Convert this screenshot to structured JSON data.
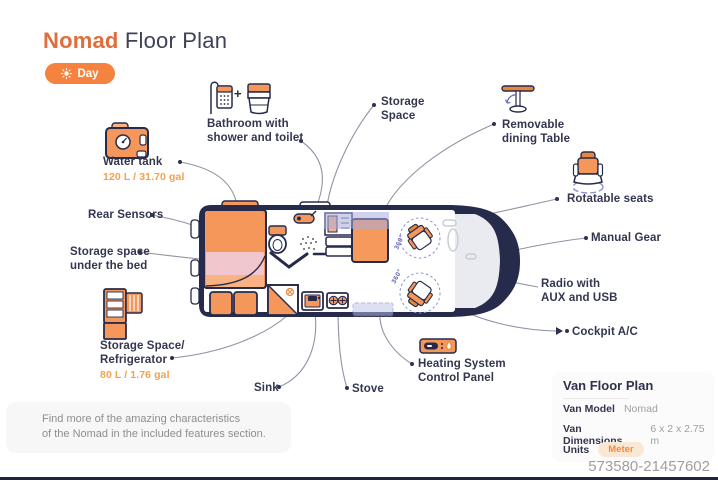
{
  "header": {
    "title_accent": "Nomad",
    "title_rest": " Floor Plan",
    "day_toggle": "Day"
  },
  "callouts": {
    "bathroom": {
      "lines": [
        "Bathroom with",
        "shower and toilet"
      ]
    },
    "storage_space": {
      "lines": [
        "Storage",
        "Space"
      ]
    },
    "dining_table": {
      "lines": [
        "Removable",
        "dining Table"
      ]
    },
    "water_tank": {
      "lines": [
        "Water tank"
      ],
      "value": "120 L / 31.70 gal"
    },
    "rear_sensors": {
      "lines": [
        "Rear Sensors"
      ]
    },
    "under_bed": {
      "lines": [
        "Storage space",
        "under the bed"
      ]
    },
    "rotatable_seats": {
      "lines": [
        "Rotatable seats"
      ]
    },
    "manual_gear": {
      "lines": [
        "Manual Gear"
      ]
    },
    "radio": {
      "lines": [
        "Radio with",
        "AUX and USB"
      ]
    },
    "cockpit_ac": {
      "lines": [
        "Cockpit A/C"
      ]
    },
    "refrigerator": {
      "lines": [
        "Storage Space/",
        "Refrigerator"
      ],
      "value": "80 L / 1.76 gal"
    },
    "sink": {
      "lines": [
        "Sink"
      ]
    },
    "stove": {
      "lines": [
        "Stove"
      ]
    },
    "heating": {
      "lines": [
        "Heating System",
        "Control Panel"
      ]
    }
  },
  "van": {
    "rotation_label": "360°"
  },
  "info_panel": {
    "title": "Van Floor Plan",
    "rows": [
      {
        "label": "Van Model",
        "value": "Nomad"
      },
      {
        "label": "Van Dimensions",
        "value": "6 x 2 x 2.75 m"
      },
      {
        "label": "Units",
        "value": "Meter"
      }
    ]
  },
  "footnote": {
    "lines": [
      "Find more of the amazing characteristics",
      "of the Nomad in the included features section."
    ]
  },
  "watermark": "573580-21457602",
  "colors": {
    "accent_orange": "#F5833F",
    "dark_navy": "#272B4B",
    "seat_orange": "#F5975A",
    "purple": "#8A8FD0",
    "pink": "#F1C6CD"
  }
}
